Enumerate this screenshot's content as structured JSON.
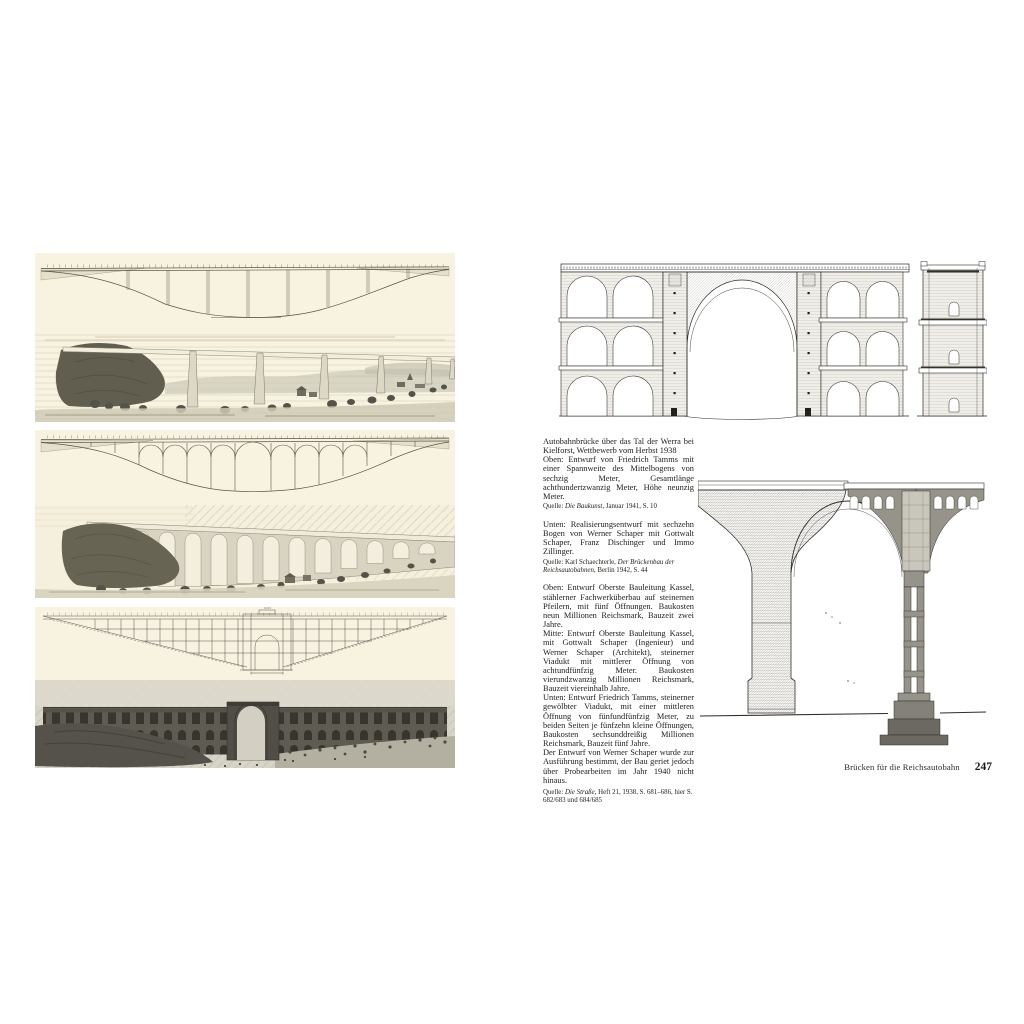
{
  "colors": {
    "page_background": "#ffffff",
    "figure_paper_cream": "#f8f3e1",
    "photo_grey": "#d7d4c8",
    "ink": "#1d1c1a"
  },
  "left_page": {
    "figures": {
      "top": "elevation-and-perspective-rendering-of-beam-bridge-design",
      "middle": "elevation-and-perspective-rendering-of-sixteen-arch-viaduct",
      "bottom": "elevation-and-model-photo-of-viaduct-with-central-arch"
    }
  },
  "right_page": {
    "captions_top": {
      "p1": "Autobahnbrücke über das Tal der Werra bei Kielforst, Wettbewerb vom Herbst 1938",
      "p2": "Oben: Entwurf von Friedrich Tamms mit einer Spannweite des Mittelbogens von sechzig Meter, Gesamtlänge achthundertzwanzig Meter, Höhe neunzig Meter.",
      "source1": {
        "prefix": "Quelle: ",
        "title": "Die Baukunst",
        "suffix": ", Januar 1941, S. 10"
      },
      "p3": "Unten: Realisierungsentwurf mit sechzehn Bogen von Werner Schaper mit Gottwalt Schaper, Franz Dischinger und Immo Zillinger.",
      "source2": {
        "prefix": "Quelle: Karl Schaechterle, ",
        "title": "Der Brückenbau der Reichsautobahnen",
        "suffix": ", Berlin 1942, S. 44"
      }
    },
    "captions_bottom": {
      "p4": "Oben: Entwurf Oberste Bauleitung Kassel, stählerner Fachwerküberbau auf steinernen Pfeilern, mit fünf Öffnungen. Baukosten neun Millionen Reichsmark, Bauzeit zwei Jahre.",
      "p5": "Mitte: Entwurf Oberste Bauleitung Kassel, mit Gottwalt Schaper (Ingenieur) und Werner Schaper (Architekt), steinerner Viadukt mit mittlerer Öffnung von achtundfünfzig Meter. Baukosten vierundzwanzig Millionen Reichsmark, Bauzeit viereinhalb Jahre.",
      "p6": "Unten: Entwurf Friedrich Tamms, steinerner gewölbter Viadukt, mit einer mittleren Öffnung von fünfundfünfzig Meter, zu beiden Seiten je fünfzehn kleine Öffnungen, Baukosten sechsunddreißig Millionen Reichsmark, Bauzeit fünf Jahre.",
      "p7": "Der Entwurf von Werner Schaper wurde zur Ausführung bestimmt, der Bau geriet jedoch über Probearbeiten im Jahr 1940 nicht hinaus.",
      "source3": {
        "prefix": "Quelle: ",
        "title": "Die Straße",
        "suffix": ", Heft 21, 1938, S. 681–686, hier S. 682/683 und 684/685"
      }
    },
    "footer": {
      "running_title": "Brücken für die Reichsautobahn",
      "page_number": "247"
    }
  }
}
